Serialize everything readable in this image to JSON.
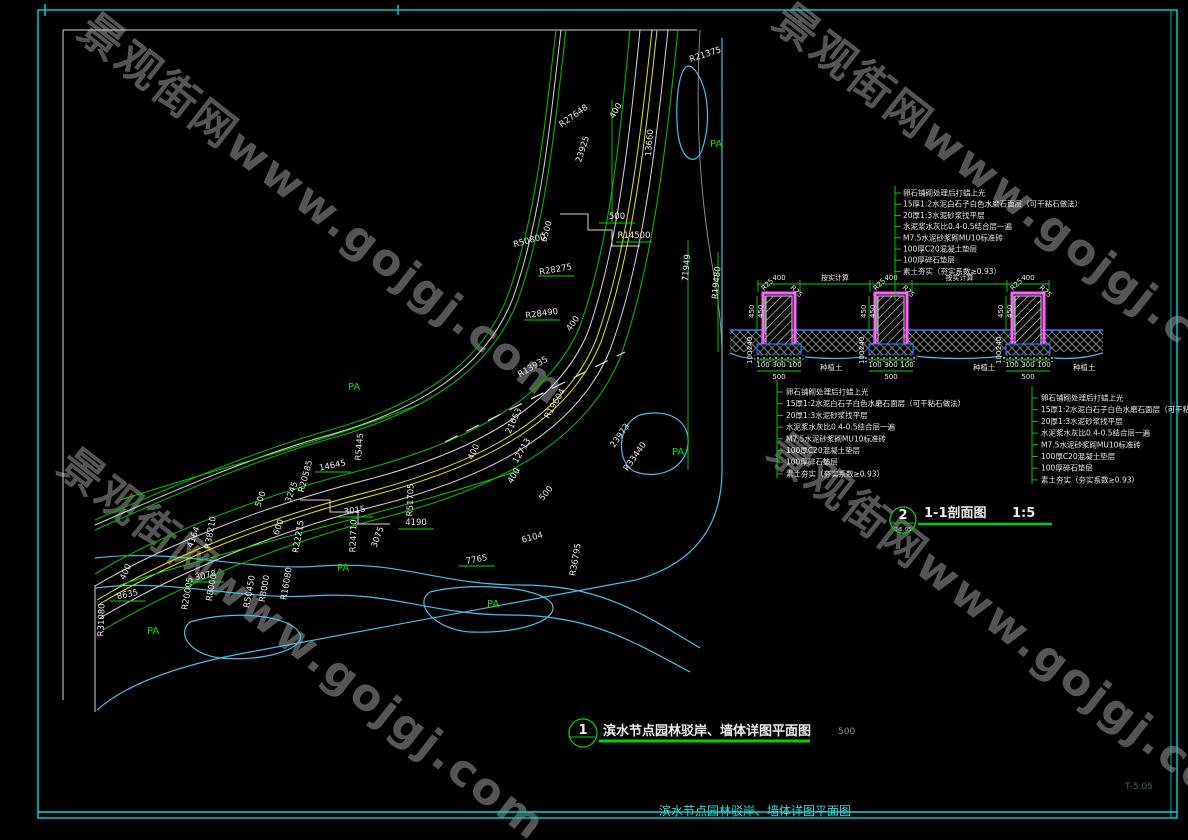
{
  "meta": {
    "watermark": "景观街网www.gojgj.com",
    "sheet_no": "T-5.05",
    "caption": "滨水节点园林驳岸、墙体详图平面图"
  },
  "plan": {
    "title": {
      "bubble": "1",
      "bubble_sub": "",
      "text": "滨水节点园林驳岸、墙体详图平面图",
      "scale": "500"
    },
    "pa_label": "PA",
    "pa_positions": [
      [
        710,
        147
      ],
      [
        348,
        390
      ],
      [
        672,
        455
      ],
      [
        337,
        571
      ],
      [
        147,
        634
      ],
      [
        487,
        607
      ]
    ],
    "labels": [
      {
        "t": "R27648",
        "x": 575,
        "y": 118,
        "r": -35
      },
      {
        "t": "23925",
        "x": 585,
        "y": 150,
        "r": -72
      },
      {
        "t": "R21375",
        "x": 706,
        "y": 57,
        "r": -18
      },
      {
        "t": "400",
        "x": 618,
        "y": 112,
        "r": -60
      },
      {
        "t": "500",
        "x": 617,
        "y": 219,
        "r": 0
      },
      {
        "t": "R50800",
        "x": 530,
        "y": 243,
        "r": -15
      },
      {
        "t": "6500",
        "x": 549,
        "y": 232,
        "r": -75
      },
      {
        "t": "R14500",
        "x": 634,
        "y": 238,
        "r": 0
      },
      {
        "t": "13660",
        "x": 652,
        "y": 143,
        "r": -85
      },
      {
        "t": "R28275",
        "x": 556,
        "y": 272,
        "r": -10
      },
      {
        "t": "71949",
        "x": 689,
        "y": 268,
        "r": -85
      },
      {
        "t": "R19480",
        "x": 719,
        "y": 283,
        "r": -85
      },
      {
        "t": "R28490",
        "x": 542,
        "y": 316,
        "r": -8
      },
      {
        "t": "400",
        "x": 575,
        "y": 325,
        "r": -55
      },
      {
        "t": "R13935",
        "x": 534,
        "y": 369,
        "r": -30
      },
      {
        "t": "R19604",
        "x": 557,
        "y": 405,
        "r": -60
      },
      {
        "t": "21653",
        "x": 516,
        "y": 422,
        "r": -65
      },
      {
        "t": "12713",
        "x": 524,
        "y": 452,
        "r": -60
      },
      {
        "t": "400",
        "x": 476,
        "y": 453,
        "r": -65
      },
      {
        "t": "400",
        "x": 516,
        "y": 477,
        "r": -60
      },
      {
        "t": "23973",
        "x": 622,
        "y": 437,
        "r": -55
      },
      {
        "t": "R33440",
        "x": 637,
        "y": 458,
        "r": -55
      },
      {
        "t": "500",
        "x": 548,
        "y": 495,
        "r": -50
      },
      {
        "t": "6104",
        "x": 533,
        "y": 540,
        "r": -15
      },
      {
        "t": "R36795",
        "x": 578,
        "y": 560,
        "r": -80
      },
      {
        "t": "7765",
        "x": 477,
        "y": 562,
        "r": -10
      },
      {
        "t": "R51705",
        "x": 413,
        "y": 500,
        "r": -88
      },
      {
        "t": "4190",
        "x": 416,
        "y": 525,
        "r": 0
      },
      {
        "t": "3015",
        "x": 355,
        "y": 513,
        "r": -8
      },
      {
        "t": "R24710",
        "x": 356,
        "y": 536,
        "r": -88
      },
      {
        "t": "R5445",
        "x": 362,
        "y": 447,
        "r": -85
      },
      {
        "t": "14645",
        "x": 333,
        "y": 468,
        "r": -12
      },
      {
        "t": "R20585",
        "x": 308,
        "y": 477,
        "r": -75
      },
      {
        "t": "3245",
        "x": 294,
        "y": 493,
        "r": -70
      },
      {
        "t": "R22215",
        "x": 301,
        "y": 537,
        "r": -80
      },
      {
        "t": "500",
        "x": 263,
        "y": 500,
        "r": -70
      },
      {
        "t": "600",
        "x": 281,
        "y": 528,
        "r": -70
      },
      {
        "t": "R38210",
        "x": 213,
        "y": 533,
        "r": -80
      },
      {
        "t": "4164",
        "x": 196,
        "y": 538,
        "r": -70
      },
      {
        "t": "3075",
        "x": 380,
        "y": 538,
        "r": -70
      },
      {
        "t": "400",
        "x": 128,
        "y": 573,
        "r": -65
      },
      {
        "t": "8635",
        "x": 128,
        "y": 597,
        "r": -12
      },
      {
        "t": "R31080",
        "x": 104,
        "y": 620,
        "r": -88
      },
      {
        "t": "3078",
        "x": 206,
        "y": 578,
        "r": -12
      },
      {
        "t": "R20005",
        "x": 190,
        "y": 594,
        "r": -80
      },
      {
        "t": "R8000",
        "x": 214,
        "y": 588,
        "r": -80
      },
      {
        "t": "R50450",
        "x": 252,
        "y": 592,
        "r": -80
      },
      {
        "t": "R8000",
        "x": 267,
        "y": 589,
        "r": -80
      },
      {
        "t": "R16080",
        "x": 289,
        "y": 584,
        "r": -80
      }
    ]
  },
  "section": {
    "title": {
      "bubble": "2",
      "bubble_sub": "T-5.05",
      "text": "1-1剖面图",
      "scale": "1:5"
    },
    "notes": [
      "卵石铺砌处理后打蜡上光",
      "15厚1:2水泥白石子白色水磨石面层（可干粘石做法）",
      "20厚1:3水泥砂浆找平层",
      "水泥浆水灰比0.4-0.5结合层一遍",
      "M7.5水泥砂浆砌MU10标准砖",
      "100厚C20混凝土垫层",
      "100厚碎石垫层",
      "素土夯实（夯实系数≥0.93）"
    ],
    "dims": {
      "pier_width": "400",
      "spacing": "按实计算",
      "v1": "450",
      "v2": "450",
      "v3": "240",
      "v4": "100",
      "corner": "R25",
      "foot_parts": [
        "100",
        "300",
        "100"
      ],
      "foot_total": "500"
    },
    "soil_label": "种植土"
  }
}
